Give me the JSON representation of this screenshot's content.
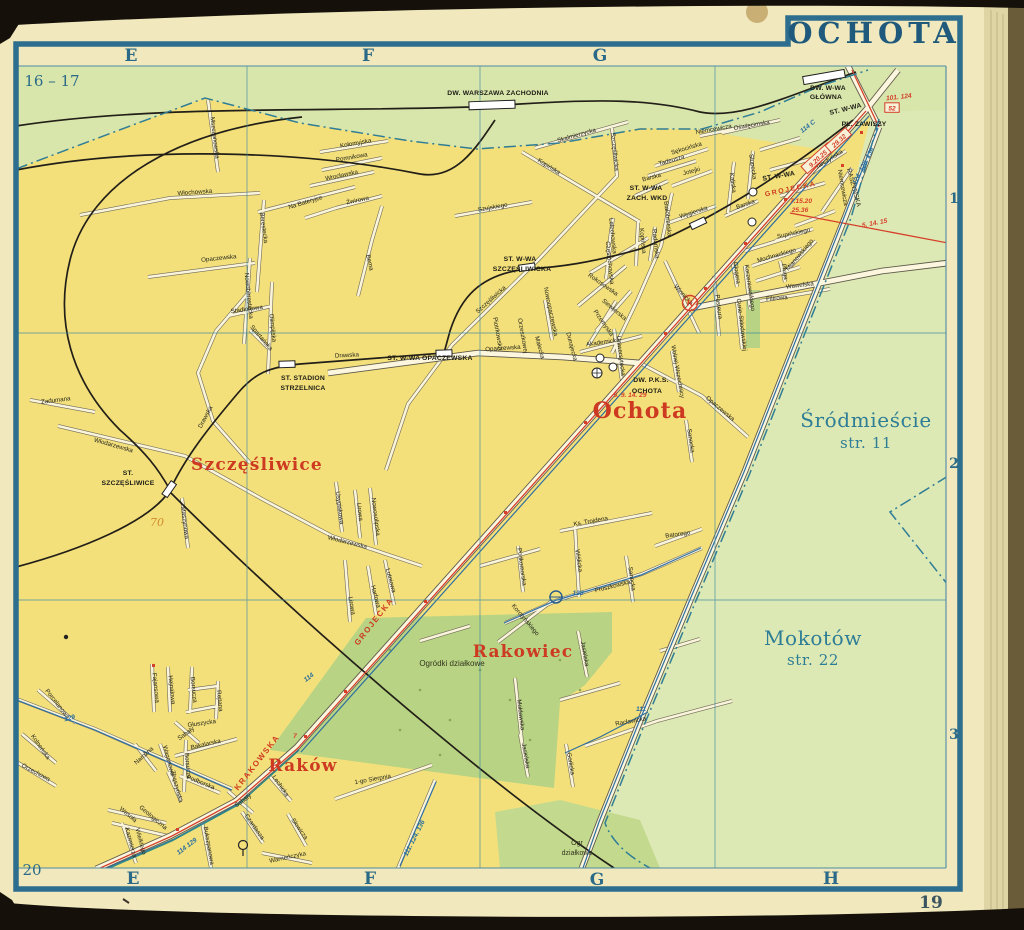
{
  "page": {
    "title": "OCHOTA",
    "sheet_ref_top_left": "16 – 17",
    "sheet_ref_bottom_left": "20",
    "page_number": "19"
  },
  "grid": {
    "top_letters": [
      "E",
      "F",
      "G"
    ],
    "bottom_letters": [
      "E",
      "F",
      "G",
      "H"
    ],
    "row_numbers": [
      "1",
      "2",
      "3"
    ]
  },
  "districts": [
    {
      "t": "Ochota",
      "x": 640,
      "y": 418,
      "fs": 22
    },
    {
      "t": "Szczęśliwice",
      "x": 257,
      "y": 470,
      "fs": 17
    },
    {
      "t": "Rakowiec",
      "x": 523,
      "y": 657,
      "fs": 17
    },
    {
      "t": "Raków",
      "x": 303,
      "y": 771,
      "fs": 17
    }
  ],
  "neighbor_labels": [
    {
      "t": "Śródmieście",
      "x": 866,
      "y": 427,
      "fs": 20
    },
    {
      "t": "str. 11",
      "x": 866,
      "y": 448,
      "fs": 15
    },
    {
      "t": "Mokotów",
      "x": 813,
      "y": 645,
      "fs": 20
    },
    {
      "t": "str. 22",
      "x": 813,
      "y": 665,
      "fs": 15
    }
  ],
  "stations": [
    {
      "t": "DW. WARSZAWA ZACHODNIA",
      "x": 498,
      "y": 95
    },
    {
      "t": "DW. W-WA",
      "x": 828,
      "y": 90
    },
    {
      "t": "GŁÓWNA",
      "x": 826,
      "y": 99
    },
    {
      "t": "ST. W-WA",
      "x": 846,
      "y": 111,
      "r": -14
    },
    {
      "t": "PL. ZAWISZY",
      "x": 864,
      "y": 126
    },
    {
      "t": "ST. W-WA",
      "x": 646,
      "y": 190
    },
    {
      "t": "ZACH. WKD",
      "x": 647,
      "y": 200
    },
    {
      "t": "ST. W-WA",
      "x": 520,
      "y": 261
    },
    {
      "t": "SZCZĘŚLIWICKA",
      "x": 522,
      "y": 271
    },
    {
      "t": "ST. W-WA OPACZEWSKA",
      "x": 430,
      "y": 360
    },
    {
      "t": "ST. STADION",
      "x": 303,
      "y": 380
    },
    {
      "t": "STRZELNICA",
      "x": 303,
      "y": 390
    },
    {
      "t": "ST.",
      "x": 128,
      "y": 475
    },
    {
      "t": "SZCZĘŚLIWICE",
      "x": 128,
      "y": 485
    },
    {
      "t": "DW. P.K.S.",
      "x": 651,
      "y": 382
    },
    {
      "t": "OCHOTA",
      "x": 647,
      "y": 393
    },
    {
      "t": "ST. W-WA",
      "x": 779,
      "y": 178,
      "r": -10
    }
  ],
  "red_street_labels": [
    {
      "t": "GROJECKA",
      "x": 376,
      "y": 623,
      "r": -52
    },
    {
      "t": "GROJECKA",
      "x": 791,
      "y": 191,
      "r": -12,
      "fs": 7
    },
    {
      "t": "KRAKOWSKA",
      "x": 259,
      "y": 764,
      "r": -52
    }
  ],
  "route_labels": [
    {
      "t": "114 C",
      "x": 809,
      "y": 128,
      "r": -38,
      "c": "blue"
    },
    {
      "t": "124. 128. 136",
      "x": 865,
      "y": 167,
      "r": -63,
      "c": "blue"
    },
    {
      "t": "111. 124. 136",
      "x": 416,
      "y": 839,
      "r": -63,
      "c": "blue"
    },
    {
      "t": "128",
      "x": 578,
      "y": 595,
      "c": "blue"
    },
    {
      "t": "111",
      "x": 641,
      "y": 711,
      "c": "blue"
    },
    {
      "t": "114",
      "x": 310,
      "y": 679,
      "r": -37,
      "c": "blue"
    },
    {
      "t": "129",
      "x": 70,
      "y": 720,
      "r": -14,
      "c": "blue"
    },
    {
      "t": "114 129",
      "x": 188,
      "y": 848,
      "r": -37,
      "c": "blue"
    },
    {
      "t": "9.20.25",
      "x": 819,
      "y": 160,
      "r": -42,
      "c": "red",
      "box": true
    },
    {
      "t": "29.32",
      "x": 840,
      "y": 142,
      "r": -42,
      "c": "red",
      "box": true
    },
    {
      "t": "52",
      "x": 892,
      "y": 110,
      "c": "red",
      "box": true
    },
    {
      "t": "101. 124",
      "x": 899,
      "y": 99,
      "r": -6,
      "c": "red"
    },
    {
      "t": "7.15.20",
      "x": 801,
      "y": 203,
      "c": "red"
    },
    {
      "t": "25.36",
      "x": 800,
      "y": 212,
      "c": "red"
    },
    {
      "t": "5. 14. 15",
      "x": 875,
      "y": 225,
      "r": -11,
      "c": "red"
    },
    {
      "t": "5. 9. 14. 29",
      "x": 630,
      "y": 397,
      "c": "red"
    },
    {
      "t": "7",
      "x": 295,
      "y": 738,
      "c": "red"
    },
    {
      "t": "K",
      "x": 690,
      "y": 306,
      "c": "red",
      "fs": 9
    }
  ],
  "poi_labels": [
    {
      "t": "Ogródki działkowe",
      "x": 452,
      "y": 666
    },
    {
      "t": "Ogr",
      "x": 577,
      "y": 845,
      "fs": 7
    },
    {
      "t": "działkowe",
      "x": 577,
      "y": 855,
      "fs": 7
    },
    {
      "t": "70",
      "x": 157,
      "y": 526,
      "cl": "hand"
    }
  ],
  "street_labels": [
    {
      "t": "Mszczonowska",
      "x": 213,
      "y": 138,
      "r": 83
    },
    {
      "t": "Kołomyjska",
      "x": 356,
      "y": 145,
      "r": -10
    },
    {
      "t": "Pomnikowa",
      "x": 352,
      "y": 159,
      "r": -10
    },
    {
      "t": "Wrocławska",
      "x": 342,
      "y": 177,
      "r": -12
    },
    {
      "t": "Żwirowa",
      "x": 358,
      "y": 202,
      "r": -12
    },
    {
      "t": "Na Bateryjce",
      "x": 306,
      "y": 204,
      "r": -17
    },
    {
      "t": "Włochowska",
      "x": 195,
      "y": 194,
      "r": -4
    },
    {
      "t": "Berestecka",
      "x": 262,
      "y": 228,
      "r": 82
    },
    {
      "t": "Opaczewska",
      "x": 219,
      "y": 260,
      "r": -6
    },
    {
      "t": "Nowoberestecka",
      "x": 247,
      "y": 296,
      "r": 84
    },
    {
      "t": "Olimpijska",
      "x": 271,
      "y": 328,
      "r": 84
    },
    {
      "t": "Stadionowa",
      "x": 247,
      "y": 311,
      "r": -8
    },
    {
      "t": "Spartańska",
      "x": 260,
      "y": 339,
      "r": 50
    },
    {
      "t": "Bema",
      "x": 368,
      "y": 263,
      "r": 77
    },
    {
      "t": "Drawska",
      "x": 207,
      "y": 418,
      "r": -62
    },
    {
      "t": "Drawska",
      "x": 347,
      "y": 357,
      "r": -3
    },
    {
      "t": "Zadumana",
      "x": 56,
      "y": 402,
      "r": -7
    },
    {
      "t": "Włodarzewska",
      "x": 113,
      "y": 447,
      "r": 16
    },
    {
      "t": "Maszynowa",
      "x": 183,
      "y": 523,
      "r": 83
    },
    {
      "t": "Usypiskowa",
      "x": 338,
      "y": 508,
      "r": 83
    },
    {
      "t": "Lirowa",
      "x": 358,
      "y": 512,
      "r": 83
    },
    {
      "t": "Nowosolipska",
      "x": 374,
      "y": 517,
      "r": 83
    },
    {
      "t": "Włodarzewska",
      "x": 347,
      "y": 544,
      "r": 14
    },
    {
      "t": "Szujskiego",
      "x": 493,
      "y": 209,
      "r": -10
    },
    {
      "t": "Skalmierzycka",
      "x": 577,
      "y": 137,
      "r": -16
    },
    {
      "t": "Kopińska",
      "x": 548,
      "y": 168,
      "r": 32
    },
    {
      "t": "Kopińska",
      "x": 641,
      "y": 241,
      "r": 84
    },
    {
      "t": "Radomska",
      "x": 654,
      "y": 244,
      "r": 84
    },
    {
      "t": "Lelechowska",
      "x": 611,
      "y": 236,
      "r": 84
    },
    {
      "t": "Częstochowska",
      "x": 608,
      "y": 263,
      "r": 84
    },
    {
      "t": "Szczęśliwicka",
      "x": 613,
      "y": 152,
      "r": 84
    },
    {
      "t": "Szczęśliwicka",
      "x": 492,
      "y": 301,
      "r": -42
    },
    {
      "t": "Rokosowska",
      "x": 602,
      "y": 286,
      "r": 35
    },
    {
      "t": "Siewierska",
      "x": 613,
      "y": 311,
      "r": 40
    },
    {
      "t": "Przemyska",
      "x": 602,
      "y": 324,
      "r": 55
    },
    {
      "t": "Białobrzeska",
      "x": 666,
      "y": 219,
      "r": 84
    },
    {
      "t": "Nowoopaczewska",
      "x": 549,
      "y": 312,
      "r": 78
    },
    {
      "t": "Dunajecka",
      "x": 570,
      "y": 347,
      "r": 75
    },
    {
      "t": "Małecka",
      "x": 538,
      "y": 348,
      "r": 75
    },
    {
      "t": "Orzeszkowej",
      "x": 521,
      "y": 336,
      "r": 80
    },
    {
      "t": "Piotrkowska",
      "x": 496,
      "y": 334,
      "r": 80
    },
    {
      "t": "Opaczewska",
      "x": 503,
      "y": 350,
      "r": -4
    },
    {
      "t": "Opaczewska",
      "x": 719,
      "y": 410,
      "r": 40
    },
    {
      "t": "Sękocińska",
      "x": 687,
      "y": 150,
      "r": -17
    },
    {
      "t": "Tadeusza",
      "x": 672,
      "y": 162,
      "r": -16
    },
    {
      "t": "Jotejki",
      "x": 692,
      "y": 173,
      "r": -15
    },
    {
      "t": "Barska",
      "x": 652,
      "y": 179,
      "r": -15
    },
    {
      "t": "Barska",
      "x": 746,
      "y": 206,
      "r": -20
    },
    {
      "t": "Węgierska",
      "x": 694,
      "y": 214,
      "r": -18
    },
    {
      "t": "Kaliska",
      "x": 731,
      "y": 183,
      "r": 82
    },
    {
      "t": "Słupecka",
      "x": 751,
      "y": 167,
      "r": 82
    },
    {
      "t": "Oświęcimska",
      "x": 752,
      "y": 127,
      "r": -10
    },
    {
      "t": "Niemcewicza",
      "x": 714,
      "y": 131,
      "r": -10
    },
    {
      "t": "Niemcewicza",
      "x": 841,
      "y": 188,
      "r": 80
    },
    {
      "t": "Tarczyńska",
      "x": 830,
      "y": 161,
      "r": -32
    },
    {
      "t": "RASZYŃSKA",
      "x": 852,
      "y": 188,
      "r": 75,
      "fs": 6.5
    },
    {
      "t": "Akademicka",
      "x": 603,
      "y": 344,
      "r": -8
    },
    {
      "t": "Uniwersytecka",
      "x": 619,
      "y": 356,
      "r": 83
    },
    {
      "t": "Mochnackiego",
      "x": 777,
      "y": 257,
      "r": -16
    },
    {
      "t": "Mianowskiego",
      "x": 801,
      "y": 256,
      "r": -50
    },
    {
      "t": "Glogera",
      "x": 735,
      "y": 273,
      "r": 82
    },
    {
      "t": "Korzeniowskiego",
      "x": 748,
      "y": 288,
      "r": 82
    },
    {
      "t": "Pługa",
      "x": 783,
      "y": 272,
      "r": 82
    },
    {
      "t": "Pasteura",
      "x": 717,
      "y": 307,
      "r": 83
    },
    {
      "t": "Curie-Skłodowskiej",
      "x": 740,
      "y": 325,
      "r": 83
    },
    {
      "t": "Wolnej Wszechnicy",
      "x": 676,
      "y": 372,
      "r": 80
    },
    {
      "t": "Winnicka",
      "x": 682,
      "y": 296,
      "r": 47
    },
    {
      "t": "Supińskiego",
      "x": 794,
      "y": 235,
      "r": -12
    },
    {
      "t": "Filtrowa",
      "x": 777,
      "y": 300,
      "r": -5
    },
    {
      "t": "Wawelska",
      "x": 800,
      "y": 287,
      "r": -7
    },
    {
      "t": "Ks. Trojdena",
      "x": 591,
      "y": 523,
      "r": -10
    },
    {
      "t": "Batorego",
      "x": 678,
      "y": 536,
      "r": -8
    },
    {
      "t": "Wiślicka",
      "x": 577,
      "y": 561,
      "r": 82
    },
    {
      "t": "Sanocka",
      "x": 689,
      "y": 441,
      "r": 82
    },
    {
      "t": "Sanocka",
      "x": 630,
      "y": 579,
      "r": 82
    },
    {
      "t": "Pruszkowska",
      "x": 613,
      "y": 588,
      "r": -14
    },
    {
      "t": "Korotyńskiego",
      "x": 524,
      "y": 621,
      "r": 50
    },
    {
      "t": "Podkomorska",
      "x": 520,
      "y": 567,
      "r": 82
    },
    {
      "t": "Mołdawska",
      "x": 519,
      "y": 715,
      "r": 83
    },
    {
      "t": "Jasielska",
      "x": 583,
      "y": 654,
      "r": 80
    },
    {
      "t": "Jasielska",
      "x": 524,
      "y": 756,
      "r": 80
    },
    {
      "t": "Gorlicka",
      "x": 569,
      "y": 764,
      "r": 80
    },
    {
      "t": "Racławicka",
      "x": 631,
      "y": 723,
      "r": -10
    },
    {
      "t": "1-go Sierpnia",
      "x": 373,
      "y": 781,
      "r": -10
    },
    {
      "t": "Bakalarska",
      "x": 206,
      "y": 746,
      "r": -13
    },
    {
      "t": "Borsucza",
      "x": 192,
      "y": 690,
      "r": 84
    },
    {
      "t": "Borsucza",
      "x": 186,
      "y": 766,
      "r": 84
    },
    {
      "t": "Fajansowa",
      "x": 154,
      "y": 688,
      "r": 84
    },
    {
      "t": "Hejnałowa",
      "x": 170,
      "y": 690,
      "r": 84
    },
    {
      "t": "Rejtana",
      "x": 218,
      "y": 701,
      "r": 84
    },
    {
      "t": "Głuszycka",
      "x": 202,
      "y": 725,
      "r": -8
    },
    {
      "t": "Narożna",
      "x": 145,
      "y": 757,
      "r": -42
    },
    {
      "t": "Wagonowa",
      "x": 167,
      "y": 761,
      "r": 75
    },
    {
      "t": "Zbąszyńska",
      "x": 175,
      "y": 787,
      "r": 75
    },
    {
      "t": "Podborska",
      "x": 200,
      "y": 784,
      "r": 22
    },
    {
      "t": "Porcelanowa",
      "x": 56,
      "y": 705,
      "r": 52
    },
    {
      "t": "Kolneńska",
      "x": 39,
      "y": 748,
      "r": 55
    },
    {
      "t": "Orzechowa",
      "x": 35,
      "y": 774,
      "r": 28
    },
    {
      "t": "Wesoła",
      "x": 127,
      "y": 816,
      "r": 40
    },
    {
      "t": "Geologiczna",
      "x": 152,
      "y": 819,
      "r": 40
    },
    {
      "t": "Kazimierza",
      "x": 129,
      "y": 843,
      "r": 75
    },
    {
      "t": "Wielkiego",
      "x": 139,
      "y": 842,
      "r": 75
    },
    {
      "t": "Sabały",
      "x": 187,
      "y": 735,
      "r": -36
    },
    {
      "t": "Sabały",
      "x": 244,
      "y": 802,
      "r": -36
    },
    {
      "t": "Lechicka",
      "x": 279,
      "y": 787,
      "r": 55
    },
    {
      "t": "Czardasza",
      "x": 253,
      "y": 828,
      "r": 55
    },
    {
      "t": "Słowicza",
      "x": 298,
      "y": 830,
      "r": 55
    },
    {
      "t": "Warneńczyka",
      "x": 288,
      "y": 859,
      "r": -12
    },
    {
      "t": "Bukszpanowa",
      "x": 207,
      "y": 846,
      "r": 80
    },
    {
      "t": "Harfowa",
      "x": 374,
      "y": 597,
      "r": 75
    },
    {
      "t": "Lutniowa",
      "x": 389,
      "y": 581,
      "r": 75
    },
    {
      "t": "Lirowa",
      "x": 350,
      "y": 606,
      "r": 80
    }
  ],
  "colors": {
    "paper": "#f1e9bd",
    "map_yellow": "#f3e07b",
    "map_green": "#d8e5ab",
    "park_green": "#b7d383",
    "frame_blue": "#2d6d8d",
    "grid_blue": "#4b8ba6",
    "label_red": "#cd3a21",
    "route_red": "#d6402a",
    "route_blue": "#2b6f9e",
    "ink": "#26261c"
  }
}
